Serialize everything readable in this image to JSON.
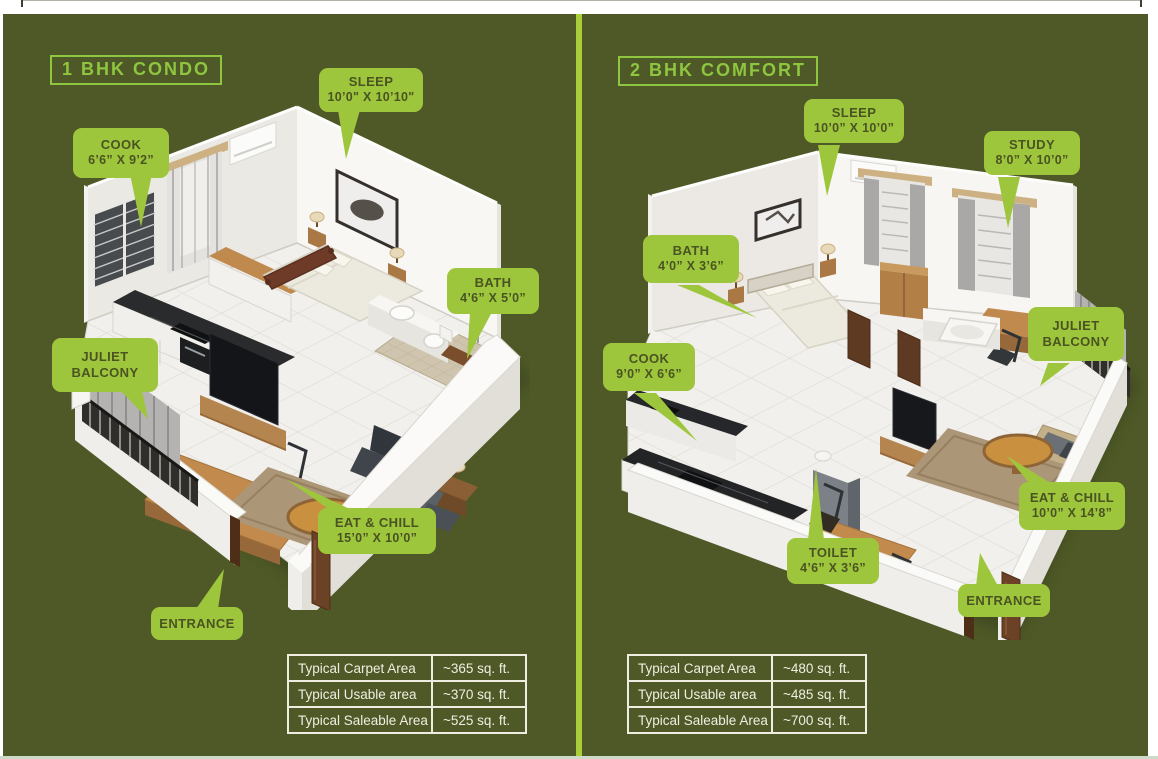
{
  "colors": {
    "background_olive": "#4e5927",
    "callout_green": "#9ec63c",
    "title_green": "#8ec63f",
    "divider_green": "#a9ce38",
    "callout_text": "#4a5322",
    "table_text": "#f0eee1",
    "footer_strip": "#ccdbc7"
  },
  "panels": [
    {
      "title": "1 BHK CONDO",
      "plan_name": "1 BHK condo isometric floor plan",
      "callouts": {
        "cook": {
          "label": "COOK",
          "dims": "6’6”  X  9’2”"
        },
        "sleep": {
          "label": "SLEEP",
          "dims": "10’0\"  X  10’10\""
        },
        "bath": {
          "label": "BATH",
          "dims": "4’6”  X  5’0”"
        },
        "juliet": {
          "label": "JULIET BALCONY"
        },
        "eat": {
          "label": "EAT & CHILL",
          "dims": "15’0”  X  10’0”"
        },
        "entrance": {
          "label": "ENTRANCE"
        }
      },
      "table": {
        "rows": [
          {
            "label": "Typical Carpet Area",
            "value": "~365 sq. ft."
          },
          {
            "label": "Typical Usable area",
            "value": "~370 sq. ft."
          },
          {
            "label": "Typical Saleable Area",
            "value": "~525 sq. ft."
          }
        ]
      }
    },
    {
      "title": "2 BHK COMFORT",
      "plan_name": "2 BHK comfort isometric floor plan",
      "callouts": {
        "sleep": {
          "label": "SLEEP",
          "dims": "10’0”  X  10’0”"
        },
        "study": {
          "label": "STUDY",
          "dims": "8’0”  X  10’0”"
        },
        "bath": {
          "label": "BATH",
          "dims": "4’0”  X  3’6”"
        },
        "cook": {
          "label": "COOK",
          "dims": "9’0”  X  6’6”"
        },
        "juliet": {
          "label": "JULIET BALCONY"
        },
        "toilet": {
          "label": "TOILET",
          "dims": "4’6”  X  3’6”"
        },
        "eat": {
          "label": "EAT & CHILL",
          "dims": "10’0”  X  14’8”"
        },
        "entrance": {
          "label": "ENTRANCE"
        }
      },
      "table": {
        "rows": [
          {
            "label": "Typical Carpet Area",
            "value": "~480 sq. ft."
          },
          {
            "label": "Typical Usable area",
            "value": "~485 sq. ft."
          },
          {
            "label": "Typical Saleable Area",
            "value": "~700 sq. ft."
          }
        ]
      }
    }
  ]
}
